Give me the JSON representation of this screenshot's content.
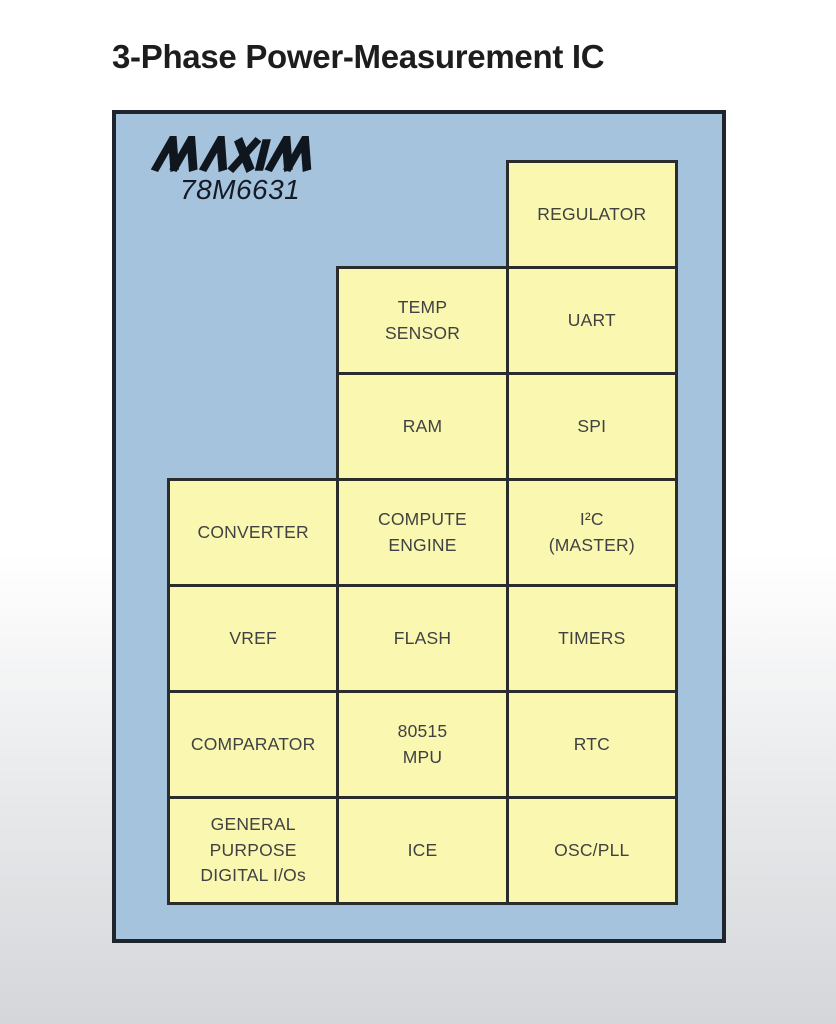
{
  "title": "3-Phase Power-Measurement IC",
  "chip": {
    "brand": "MAXIM",
    "part_number": "78M6631"
  },
  "colors": {
    "board_fill": "#a6c3dd",
    "board_border": "#20242c",
    "block_fill": "#faf7b1",
    "block_border": "#2b2d2d",
    "block_text": "#404242",
    "logo_ink": "#10161e",
    "page_bg_top": "#ffffff",
    "page_bg_bottom": "#d4d6d9"
  },
  "diagram": {
    "columns": 3,
    "rows": 7,
    "blocks": [
      {
        "label": "REGULATOR",
        "row": 0,
        "col": 2
      },
      {
        "label": "TEMP\nSENSOR",
        "row": 1,
        "col": 1
      },
      {
        "label": "UART",
        "row": 1,
        "col": 2
      },
      {
        "label": "RAM",
        "row": 2,
        "col": 1
      },
      {
        "label": "SPI",
        "row": 2,
        "col": 2
      },
      {
        "label": "CONVERTER",
        "row": 3,
        "col": 0
      },
      {
        "label": "COMPUTE\nENGINE",
        "row": 3,
        "col": 1
      },
      {
        "label": "I²C\n(MASTER)",
        "row": 3,
        "col": 2
      },
      {
        "label": "VREF",
        "row": 4,
        "col": 0
      },
      {
        "label": "FLASH",
        "row": 4,
        "col": 1
      },
      {
        "label": "TIMERS",
        "row": 4,
        "col": 2
      },
      {
        "label": "COMPARATOR",
        "row": 5,
        "col": 0
      },
      {
        "label": "80515\nMPU",
        "row": 5,
        "col": 1
      },
      {
        "label": "RTC",
        "row": 5,
        "col": 2
      },
      {
        "label": "GENERAL\nPURPOSE\nDIGITAL I/Os",
        "row": 6,
        "col": 0
      },
      {
        "label": "ICE",
        "row": 6,
        "col": 1
      },
      {
        "label": "OSC/PLL",
        "row": 6,
        "col": 2
      }
    ]
  }
}
